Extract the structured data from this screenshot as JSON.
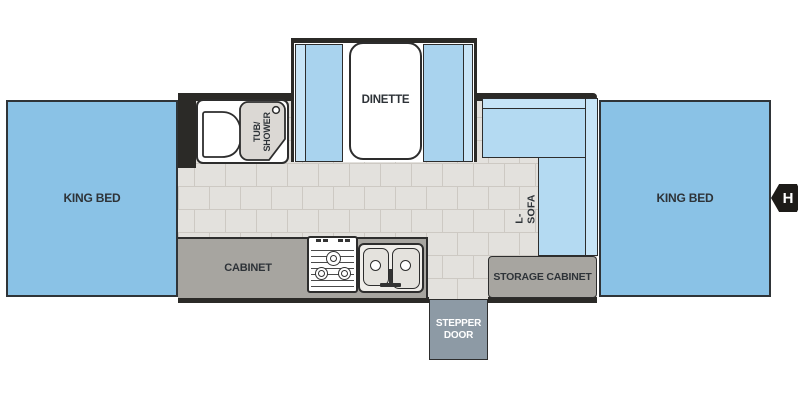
{
  "rooms": {
    "left_king_bed": "KING BED",
    "right_king_bed": "KING BED",
    "dinette": "DINETTE",
    "tub_shower": "TUB/\nSHOWER",
    "l_sofa": "L-SOFA",
    "cabinet": "CABINET",
    "storage_cabinet": "STORAGE CABINET",
    "stepper_door": "STEPPER\nDOOR",
    "marker_h": "H"
  },
  "colors": {
    "bed": "#8ac2e6",
    "bench_seat": "#a9d3ee",
    "bench_back": "#c9e5f7",
    "sofa_seat": "#b4daf2",
    "sofa_back": "#c6e4f7",
    "wall": "#2b2a27",
    "outline": "#2d2d2d",
    "cabinet": "#a7a5a0",
    "door": "#8d9aa5",
    "tile": "#e3e1dd",
    "grout": "#cdc9c3",
    "fixture": "#dbd8d4",
    "label": "#2e3338",
    "white": "#ffffff"
  }
}
